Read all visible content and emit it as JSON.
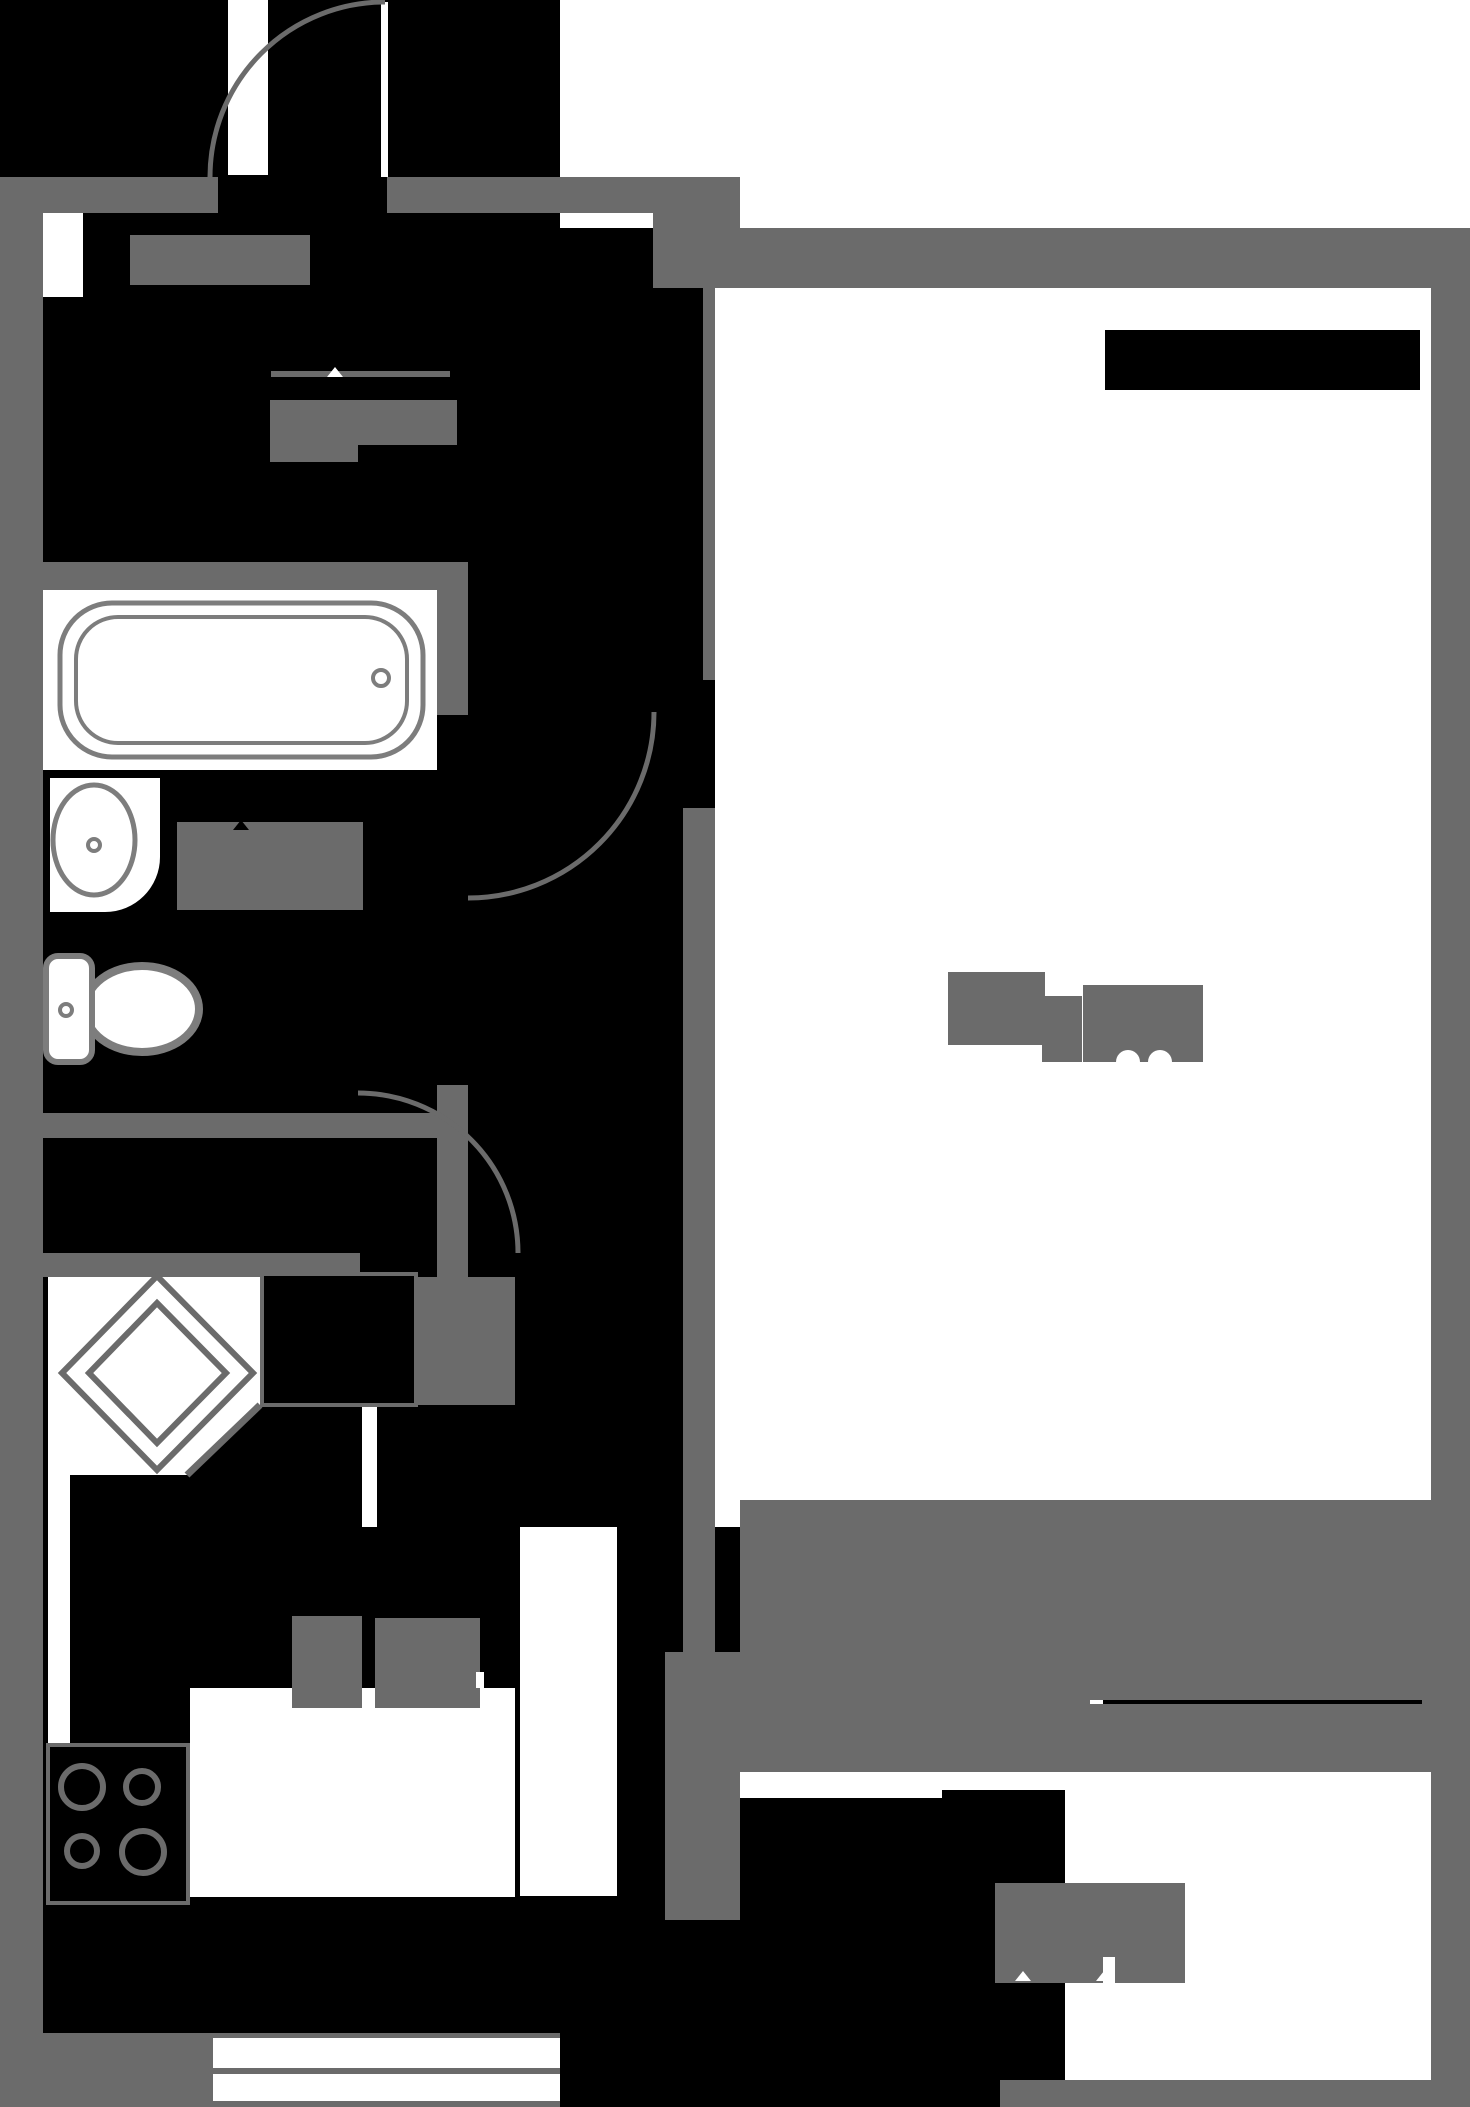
{
  "document": {
    "type": "apartment-floor-plan",
    "width_px": 1470,
    "height_px": 2107
  },
  "colors": {
    "background": "#000000",
    "wall": "#6b6b6b",
    "floor": "#ffffff",
    "fixture_outline": "#7d7d7d",
    "label_blob": "#6b6b6b"
  },
  "rooms": [
    {
      "name": "hallway"
    },
    {
      "name": "bathroom"
    },
    {
      "name": "toilet-area"
    },
    {
      "name": "corridor"
    },
    {
      "name": "kitchen"
    },
    {
      "name": "main-room"
    },
    {
      "name": "balcony"
    }
  ],
  "fixtures": [
    "bathtub",
    "wash-basin",
    "toilet",
    "stove-four-burners",
    "ventilation-shaft-diamond",
    "radiator",
    "kitchen-counter",
    "balcony-railing"
  ],
  "doors": [
    "entrance-door-arc",
    "entrance-door-leaf",
    "bathroom-door-arc",
    "kitchen-door-arc",
    "kitchen-door-leaf"
  ],
  "area_label_blobs": [
    "hall-label-blob",
    "hall-area-label-blob",
    "bathroom-area-label-blob",
    "main-room-area-label-blob",
    "kitchen-area-label-blob",
    "balcony-area-label-blob"
  ]
}
